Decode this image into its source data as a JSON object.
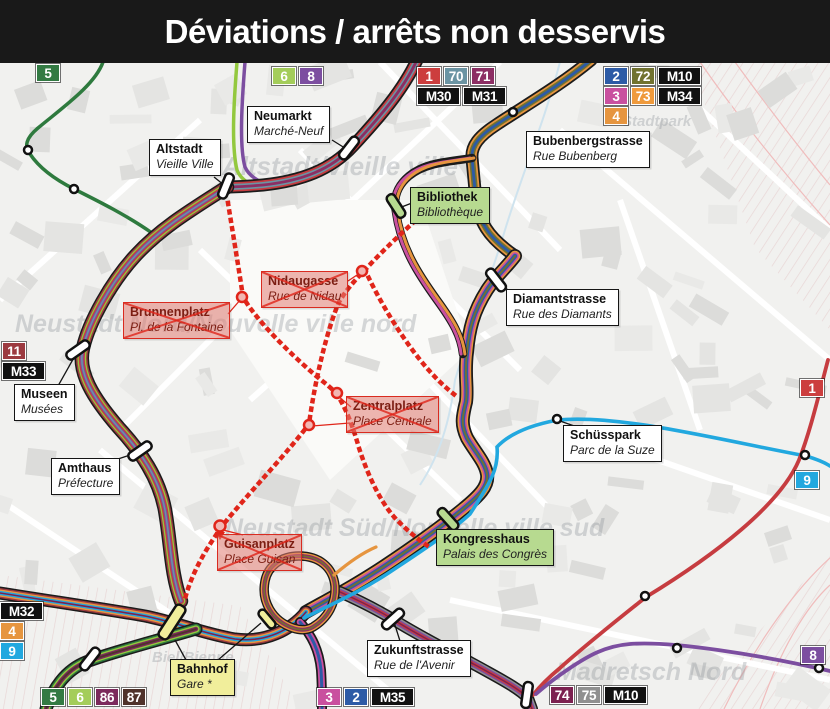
{
  "title": "Déviations / arrêts non desservis",
  "colors": {
    "black": "#1b1b1b",
    "red1": "#c63c40",
    "steel70": "#6b94a3",
    "dmag71": "#8c2e63",
    "dmag74": "#7c2150",
    "mag86": "#7c2a5c",
    "blue2": "#2d5ba6",
    "olive72": "#71722f",
    "pink3": "#c9509f",
    "orange4": "#e6953f",
    "lightblue9": "#22a8df",
    "purple8": "#7c4ea0",
    "lightgreen6": "#93c83e",
    "darkgreen5": "#2e7a3e",
    "maroon11": "#9c3a40",
    "gray75": "#909090",
    "brown87": "#4f332b",
    "closed_red": "#e0251a",
    "label_green": "#b7da90",
    "label_yellow": "#f1ee9b",
    "title_bg": "#191919"
  },
  "badge_groups": [
    {
      "name": "routes-top-5",
      "x": 36,
      "y": 64,
      "rows": [
        [
          {
            "t": "5",
            "c": "#337a43"
          }
        ]
      ]
    },
    {
      "name": "routes-top-6-8",
      "x": 272,
      "y": 67,
      "rows": [
        [
          {
            "t": "6",
            "c": "#a4cd5a"
          },
          {
            "t": "8",
            "c": "#7c4ea0"
          }
        ]
      ]
    },
    {
      "name": "routes-top-1-70-71",
      "x": 417,
      "y": 67,
      "rows": [
        [
          {
            "t": "1",
            "c": "#cc3e3e"
          },
          {
            "t": "70",
            "c": "#6b94a3"
          },
          {
            "t": "71",
            "c": "#8c2e63"
          }
        ],
        [
          {
            "t": "M30",
            "c": "#111111"
          },
          {
            "t": "M31",
            "c": "#111111"
          }
        ]
      ]
    },
    {
      "name": "routes-top-2-72-m10",
      "x": 604,
      "y": 67,
      "rows": [
        [
          {
            "t": "2",
            "c": "#2d5ba6"
          },
          {
            "t": "72",
            "c": "#71722f"
          },
          {
            "t": "M10",
            "c": "#111111"
          }
        ],
        [
          {
            "t": "3",
            "c": "#c9509f"
          },
          {
            "t": "73",
            "c": "#ef9a3c"
          },
          {
            "t": "M34",
            "c": "#111111"
          }
        ],
        [
          {
            "t": "4",
            "c": "#e6953f"
          }
        ]
      ]
    },
    {
      "name": "routes-left-11-m33",
      "x": 2,
      "y": 342,
      "rows": [
        [
          {
            "t": "11",
            "c": "#9c3a40"
          }
        ],
        [
          {
            "t": "M33",
            "c": "#111111"
          }
        ]
      ]
    },
    {
      "name": "routes-left-m32-4-9",
      "x": 0,
      "y": 602,
      "rows": [
        [
          {
            "t": "M32",
            "c": "#111111"
          }
        ],
        [
          {
            "t": "4",
            "c": "#e6953f"
          }
        ],
        [
          {
            "t": "9",
            "c": "#22a8df"
          }
        ]
      ]
    },
    {
      "name": "route-right-1",
      "x": 800,
      "y": 379,
      "rows": [
        [
          {
            "t": "1",
            "c": "#cc3e3e"
          }
        ]
      ]
    },
    {
      "name": "route-right-9",
      "x": 795,
      "y": 471,
      "rows": [
        [
          {
            "t": "9",
            "c": "#22a8df"
          }
        ]
      ]
    },
    {
      "name": "route-right-8",
      "x": 801,
      "y": 646,
      "rows": [
        [
          {
            "t": "8",
            "c": "#7c4ea0"
          }
        ]
      ]
    },
    {
      "name": "routes-bottom-5-6-86-87",
      "x": 41,
      "y": 688,
      "rows": [
        [
          {
            "t": "5",
            "c": "#337a43"
          },
          {
            "t": "6",
            "c": "#a4cd5a"
          },
          {
            "t": "86",
            "c": "#7c2a5c"
          },
          {
            "t": "87",
            "c": "#4f332b"
          }
        ]
      ]
    },
    {
      "name": "routes-bottom-3-2-m35",
      "x": 317,
      "y": 688,
      "rows": [
        [
          {
            "t": "3",
            "c": "#c9509f"
          },
          {
            "t": "2",
            "c": "#2d5ba6"
          },
          {
            "t": "M35",
            "c": "#111111"
          }
        ]
      ]
    },
    {
      "name": "routes-bottom-74-75-m10",
      "x": 550,
      "y": 686,
      "rows": [
        [
          {
            "t": "74",
            "c": "#7c2150"
          },
          {
            "t": "75",
            "c": "#909090"
          },
          {
            "t": "M10",
            "c": "#111111"
          }
        ]
      ]
    }
  ],
  "stops": {
    "white": [
      {
        "name": "neumarkt",
        "x": 247,
        "y": 106,
        "l1": "Neumarkt",
        "l2": "Marché-Neuf"
      },
      {
        "name": "altstadt",
        "x": 149,
        "y": 139,
        "l1": "Altstadt",
        "l2": "Vieille Ville"
      },
      {
        "name": "bubenbergstrasse",
        "x": 526,
        "y": 131,
        "l1": "Bubenbergstrasse",
        "l2": "Rue Bubenberg"
      },
      {
        "name": "diamantstrasse",
        "x": 506,
        "y": 289,
        "l1": "Diamantstrasse",
        "l2": "Rue des Diamants"
      },
      {
        "name": "museen",
        "x": 14,
        "y": 384,
        "l1": "Museen",
        "l2": "Musées"
      },
      {
        "name": "amthaus",
        "x": 51,
        "y": 458,
        "l1": "Amthaus",
        "l2": "Préfecture"
      },
      {
        "name": "schuesspark",
        "x": 563,
        "y": 425,
        "l1": "Schüsspark",
        "l2": "Parc de la Suze"
      },
      {
        "name": "zukunftstrasse",
        "x": 367,
        "y": 640,
        "l1": "Zukunftstrasse",
        "l2": "Rue de l'Avenir"
      }
    ],
    "green": [
      {
        "name": "bibliothek",
        "x": 410,
        "y": 187,
        "l1": "Bibliothek",
        "l2": "Bibliothèque"
      },
      {
        "name": "kongresshaus",
        "x": 436,
        "y": 529,
        "l1": "Kongresshaus",
        "l2": "Palais des Congrès"
      }
    ],
    "closed": [
      {
        "name": "brunnenplatz",
        "x": 123,
        "y": 302,
        "l1": "Brunnenplatz",
        "l2": "Pl. de la Fontaine"
      },
      {
        "name": "nidaugasse",
        "x": 261,
        "y": 271,
        "l1": "Nidaugasse",
        "l2": "Rue de Nidau"
      },
      {
        "name": "zentralplatz",
        "x": 346,
        "y": 396,
        "l1": "Zentralplatz",
        "l2": "Place Centrale"
      },
      {
        "name": "guisanplatz",
        "x": 217,
        "y": 534,
        "l1": "Guisanplatz",
        "l2": "Place Guisan"
      }
    ],
    "station": [
      {
        "name": "bahnhof",
        "x": 170,
        "y": 659,
        "l1": "Bahnhof",
        "l2": "Gare *"
      }
    ]
  },
  "watermarks": [
    {
      "name": "wm-altstadt",
      "text": "Altstadt/Vieille ville",
      "x": 222,
      "y": 175,
      "size": 26
    },
    {
      "name": "wm-stadtpark",
      "text": "Stadtpark",
      "x": 622,
      "y": 126,
      "size": 15
    },
    {
      "name": "wm-neustadt-nord",
      "text": "Neustadt Nord/Nouvelle ville nord",
      "x": 15,
      "y": 332,
      "size": 25
    },
    {
      "name": "wm-neustadt-sued",
      "text": "Neustadt Süd/Nouvelle ville sud",
      "x": 225,
      "y": 536,
      "size": 25
    },
    {
      "name": "wm-biel-bienne",
      "text": "Biel/Bienne",
      "x": 152,
      "y": 662,
      "size": 15
    },
    {
      "name": "wm-madretsch-nord",
      "text": "Madretsch Nord",
      "x": 556,
      "y": 680,
      "size": 25
    }
  ]
}
